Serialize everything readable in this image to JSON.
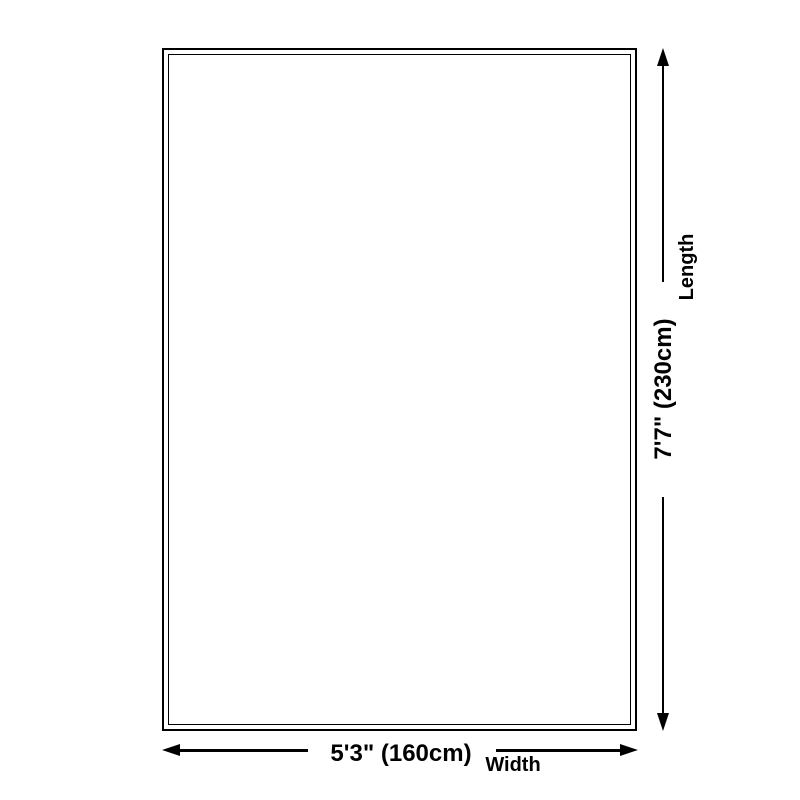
{
  "diagram": {
    "background_color": "#ffffff",
    "line_color": "#000000",
    "dimensions": {
      "length": {
        "label": "Length",
        "value": "7'7\" (230cm)"
      },
      "width": {
        "label": "Width",
        "value": "5'3\" (160cm)"
      }
    }
  }
}
